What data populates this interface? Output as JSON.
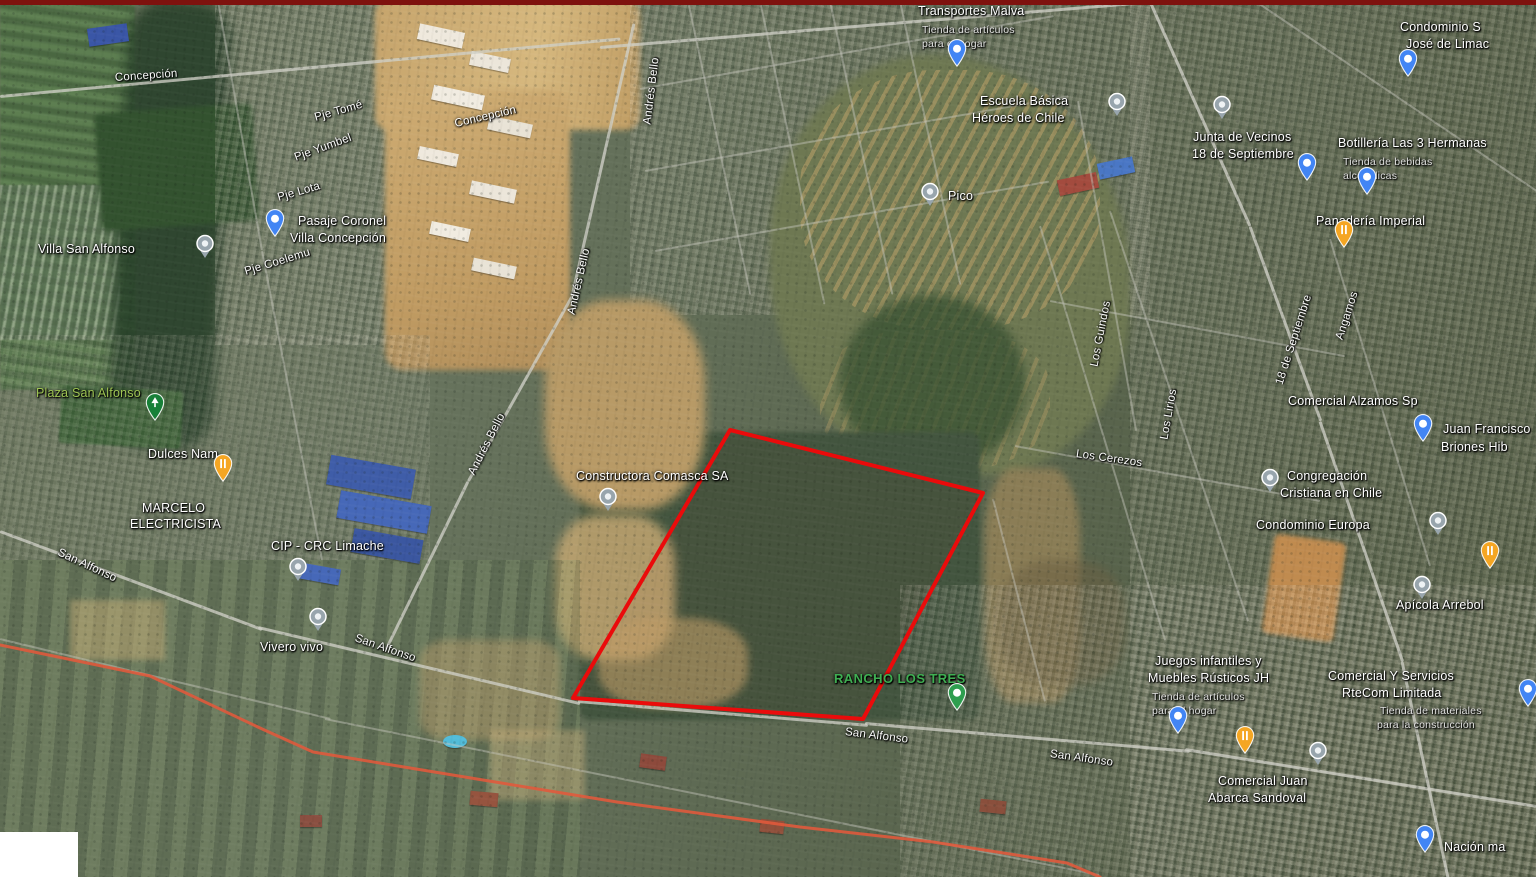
{
  "map": {
    "colors": {
      "parcel_outline": "#ea0b0b",
      "route_line": "#e2593b",
      "top_border": "#7e120e",
      "pin_blue": "#4285f4",
      "pin_gray": "#98a5ad",
      "pin_orange": "#f5a623",
      "pin_green": "#2e9e4f",
      "park_label": "#9ec453",
      "rancho_label": "#3fae52"
    },
    "parcel_outline_points": "730,430 983,493 863,719 573,698",
    "route_line_points": "0,645 150,676 260,728 313,752 483,780 617,802 800,827 933,842 1067,863 1100,877",
    "labels": [
      {
        "t": "Concepción",
        "x": 115,
        "y": 72,
        "r": -4,
        "c": "s"
      },
      {
        "t": "Concepción",
        "x": 455,
        "y": 118,
        "r": -13,
        "c": "s"
      },
      {
        "t": "Pje Tomé",
        "x": 315,
        "y": 112,
        "r": -16,
        "c": "s"
      },
      {
        "t": "Pje Yumbel",
        "x": 295,
        "y": 152,
        "r": -20,
        "c": "s"
      },
      {
        "t": "Pje Lota",
        "x": 278,
        "y": 192,
        "r": -16,
        "c": "s"
      },
      {
        "t": "Pasaje Coronel",
        "x": 298,
        "y": 214,
        "r": 0,
        "c": "p"
      },
      {
        "t": "Villa Concepción",
        "x": 290,
        "y": 231,
        "r": 0,
        "c": "p"
      },
      {
        "t": "Pje Coelemu",
        "x": 245,
        "y": 266,
        "r": -17,
        "c": "s"
      },
      {
        "t": "Andrés Bello",
        "x": 648,
        "y": 118,
        "r": -83,
        "c": "s"
      },
      {
        "t": "Andrés Bello",
        "x": 572,
        "y": 308,
        "r": -77,
        "c": "s"
      },
      {
        "t": "Andrés Bello",
        "x": 472,
        "y": 468,
        "r": -63,
        "c": "s"
      },
      {
        "t": "Villa San Alfonso",
        "x": 38,
        "y": 242,
        "r": 0,
        "c": "a"
      },
      {
        "t": "Plaza San Alfonso",
        "x": 36,
        "y": 386,
        "r": 0,
        "c": "gp"
      },
      {
        "t": "Dulces Nam",
        "x": 148,
        "y": 447,
        "r": 0,
        "c": "p"
      },
      {
        "t": "MARCELO",
        "x": 142,
        "y": 501,
        "r": 0,
        "c": "p"
      },
      {
        "t": "ELECTRICISTA",
        "x": 130,
        "y": 517,
        "r": 0,
        "c": "p"
      },
      {
        "t": "CIP - CRC Limache",
        "x": 271,
        "y": 539,
        "r": 0,
        "c": "p"
      },
      {
        "t": "San Alfonso",
        "x": 58,
        "y": 546,
        "r": 25,
        "c": "s"
      },
      {
        "t": "Vivero vivo",
        "x": 260,
        "y": 640,
        "r": 0,
        "c": "p"
      },
      {
        "t": "San Alfonso",
        "x": 355,
        "y": 632,
        "r": 19,
        "c": "s"
      },
      {
        "t": "San Alfonso",
        "x": 845,
        "y": 726,
        "r": 7,
        "c": "s"
      },
      {
        "t": "San Alfonso",
        "x": 1050,
        "y": 748,
        "r": 8,
        "c": "s"
      },
      {
        "t": "Constructora Comasca SA",
        "x": 576,
        "y": 469,
        "r": 0,
        "c": "p"
      },
      {
        "t": "RANCHO LOS TRES",
        "x": 834,
        "y": 672,
        "r": 0,
        "c": "gb"
      },
      {
        "t": "Pico",
        "x": 948,
        "y": 189,
        "r": 0,
        "c": "a"
      },
      {
        "t": "Transportes Malva",
        "x": 918,
        "y": 4,
        "r": 0,
        "c": "p"
      },
      {
        "t": "Tienda de artículos",
        "x": 922,
        "y": 24,
        "r": 0,
        "c": "sub"
      },
      {
        "t": "para el hogar",
        "x": 922,
        "y": 38,
        "r": 0,
        "c": "sub"
      },
      {
        "t": "Escuela Básica",
        "x": 980,
        "y": 94,
        "r": 0,
        "c": "p"
      },
      {
        "t": "Héroes de Chile",
        "x": 972,
        "y": 111,
        "r": 0,
        "c": "p"
      },
      {
        "t": "Condominio S",
        "x": 1400,
        "y": 20,
        "r": 0,
        "c": "p"
      },
      {
        "t": "José de Limac",
        "x": 1406,
        "y": 37,
        "r": 0,
        "c": "p"
      },
      {
        "t": "Junta de Vecinos",
        "x": 1193,
        "y": 130,
        "r": 0,
        "c": "p"
      },
      {
        "t": "18 de Septiembre",
        "x": 1192,
        "y": 147,
        "r": 0,
        "c": "p"
      },
      {
        "t": "Botillería Las 3 Hermanas",
        "x": 1338,
        "y": 136,
        "r": 0,
        "c": "p"
      },
      {
        "t": "Tienda de bebidas",
        "x": 1343,
        "y": 156,
        "r": 0,
        "c": "sub"
      },
      {
        "t": "alcohólicas",
        "x": 1343,
        "y": 170,
        "r": 0,
        "c": "sub"
      },
      {
        "t": "Panadería Imperial",
        "x": 1316,
        "y": 214,
        "r": 0,
        "c": "p"
      },
      {
        "t": "18 de Septiembre",
        "x": 1280,
        "y": 378,
        "r": -72,
        "c": "s"
      },
      {
        "t": "Angamos",
        "x": 1340,
        "y": 333,
        "r": -72,
        "c": "s"
      },
      {
        "t": "Los Guindos",
        "x": 1095,
        "y": 360,
        "r": -79,
        "c": "s"
      },
      {
        "t": "Los Lirios",
        "x": 1165,
        "y": 433,
        "r": -80,
        "c": "s"
      },
      {
        "t": "Los Cerezos",
        "x": 1076,
        "y": 448,
        "r": 8,
        "c": "s"
      },
      {
        "t": "Comercial Alzamos Sp",
        "x": 1288,
        "y": 394,
        "r": 0,
        "c": "p"
      },
      {
        "t": "Juan Francisco",
        "x": 1443,
        "y": 422,
        "r": 0,
        "c": "p"
      },
      {
        "t": "Briones Hib",
        "x": 1441,
        "y": 440,
        "r": 0,
        "c": "p"
      },
      {
        "t": "Congregación",
        "x": 1287,
        "y": 469,
        "r": 0,
        "c": "p"
      },
      {
        "t": "Cristiana en Chile",
        "x": 1280,
        "y": 486,
        "r": 0,
        "c": "p"
      },
      {
        "t": "Condominio Europa",
        "x": 1256,
        "y": 518,
        "r": 0,
        "c": "p"
      },
      {
        "t": "Apícola Arrebol",
        "x": 1396,
        "y": 598,
        "r": 0,
        "c": "p"
      },
      {
        "t": "Juegos infantiles y",
        "x": 1155,
        "y": 654,
        "r": 0,
        "c": "p"
      },
      {
        "t": "Muebles Rústicos JH",
        "x": 1148,
        "y": 671,
        "r": 0,
        "c": "p"
      },
      {
        "t": "Tienda de artículos",
        "x": 1152,
        "y": 691,
        "r": 0,
        "c": "sub"
      },
      {
        "t": "para el hogar",
        "x": 1152,
        "y": 705,
        "r": 0,
        "c": "sub"
      },
      {
        "t": "Comercial Y Servicios",
        "x": 1328,
        "y": 669,
        "r": 0,
        "c": "p"
      },
      {
        "t": "RteCom Limitada",
        "x": 1342,
        "y": 686,
        "r": 0,
        "c": "p"
      },
      {
        "t": "Tienda de materiales",
        "x": 1380,
        "y": 705,
        "r": 0,
        "c": "sub"
      },
      {
        "t": "para la construcción",
        "x": 1377,
        "y": 719,
        "r": 0,
        "c": "sub"
      },
      {
        "t": "Comercial Juan",
        "x": 1218,
        "y": 774,
        "r": 0,
        "c": "p"
      },
      {
        "t": "Abarca Sandoval",
        "x": 1208,
        "y": 791,
        "r": 0,
        "c": "p"
      },
      {
        "t": "Nación ma",
        "x": 1444,
        "y": 840,
        "r": 0,
        "c": "p"
      }
    ],
    "pins": [
      {
        "k": "blue",
        "x": 957,
        "y": 66
      },
      {
        "k": "blue",
        "x": 1408,
        "y": 76
      },
      {
        "k": "blue",
        "x": 1367,
        "y": 194
      },
      {
        "k": "blue",
        "x": 1307,
        "y": 180
      },
      {
        "k": "blue",
        "x": 275,
        "y": 236
      },
      {
        "k": "blue",
        "x": 1423,
        "y": 441
      },
      {
        "k": "blue",
        "x": 1178,
        "y": 733
      },
      {
        "k": "blue",
        "x": 1528,
        "y": 706
      },
      {
        "k": "blue",
        "x": 1425,
        "y": 852
      },
      {
        "k": "gray",
        "x": 1222,
        "y": 110
      },
      {
        "k": "gray",
        "x": 1117,
        "y": 107
      },
      {
        "k": "gray",
        "x": 930,
        "y": 197
      },
      {
        "k": "gray",
        "x": 205,
        "y": 249
      },
      {
        "k": "gray",
        "x": 318,
        "y": 622
      },
      {
        "k": "gray",
        "x": 298,
        "y": 572
      },
      {
        "k": "gray",
        "x": 608,
        "y": 502
      },
      {
        "k": "gray",
        "x": 1270,
        "y": 483
      },
      {
        "k": "gray",
        "x": 1438,
        "y": 526
      },
      {
        "k": "gray",
        "x": 1422,
        "y": 590
      },
      {
        "k": "gray",
        "x": 1318,
        "y": 756
      },
      {
        "k": "orange",
        "x": 1344,
        "y": 247
      },
      {
        "k": "orange",
        "x": 223,
        "y": 481
      },
      {
        "k": "orange",
        "x": 1245,
        "y": 753
      },
      {
        "k": "orange",
        "x": 1490,
        "y": 568
      },
      {
        "k": "green",
        "x": 957,
        "y": 710
      },
      {
        "k": "park",
        "x": 155,
        "y": 420
      }
    ]
  }
}
